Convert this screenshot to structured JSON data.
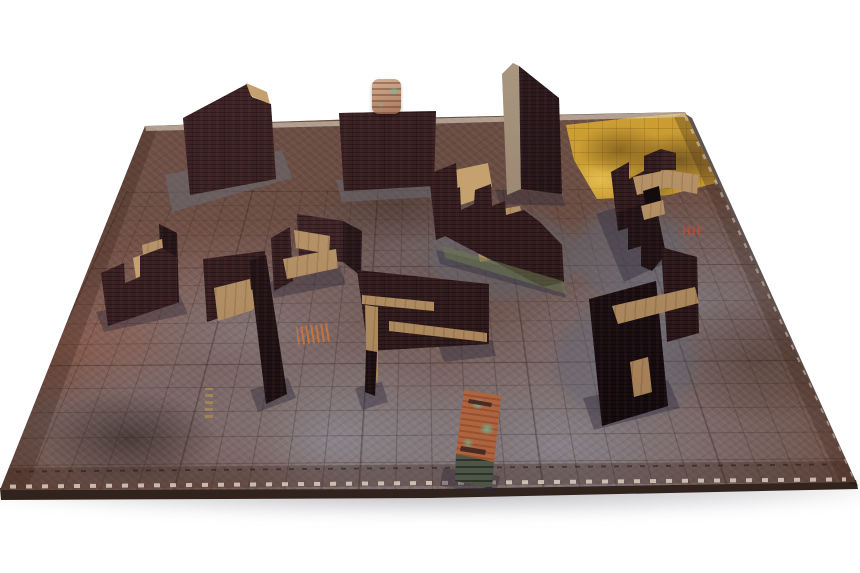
{
  "scene": {
    "description": "Tabletop wargaming battle mat with modular dark-brick ruin wall terrain pieces and two rusted crates photographed on a white background",
    "background_color": "#ffffff",
    "mat": {
      "name": "industrial-grunge-battle-mat",
      "shape": "rectangular mat viewed in perspective",
      "grid": "square grid printed on surface",
      "base_color": "#6f5047",
      "weathering_colors": [
        "#9aa8bc",
        "#8a5243",
        "#33261e"
      ],
      "hazard_patch_color": "#c89a2e",
      "edge_markings": "dashed border lines along mat edges"
    },
    "materials": {
      "wall_brick_color": "#351d21",
      "wall_shadow_color": "#241419",
      "wood_walkway_color": "#b0885a",
      "bare_panel_color": "#97816a",
      "moss_color": "#6c7a4e",
      "crate_rust_color": "#b4663e",
      "crate_teal_color": "#62c2a4"
    },
    "pieces": [
      {
        "name": "large-wall-top-left",
        "type": "brick wall section with bare corner flap"
      },
      {
        "name": "small-crate-on-wall",
        "type": "small rusted crate with teal marking"
      },
      {
        "name": "wall-top-center",
        "type": "large brick wall section"
      },
      {
        "name": "thin-wall-center",
        "type": "brick wall corner showing bare back panel"
      },
      {
        "name": "zigzag-wall-top-right",
        "type": "crenellated brick wall with wooden walkways and doorway"
      },
      {
        "name": "corner-wall-right",
        "type": "brick corner ruin with wooden walkway"
      },
      {
        "name": "notched-wall-left",
        "type": "brick wall with crenel notch and wooden platform"
      },
      {
        "name": "corner-wall-center",
        "type": "brick corner ruin with interior platform"
      },
      {
        "name": "u-enclosure-center",
        "type": "U-shaped brick enclosure with walkways"
      },
      {
        "name": "crenellated-wall-mid",
        "type": "long crenellated brick wall with ramp and mossy base"
      },
      {
        "name": "l-structure-center",
        "type": "L-shaped brick structure with wooden ledges"
      },
      {
        "name": "crate-foreground",
        "type": "rusted crate with teal splatter markings"
      }
    ],
    "piece_count": 12
  }
}
